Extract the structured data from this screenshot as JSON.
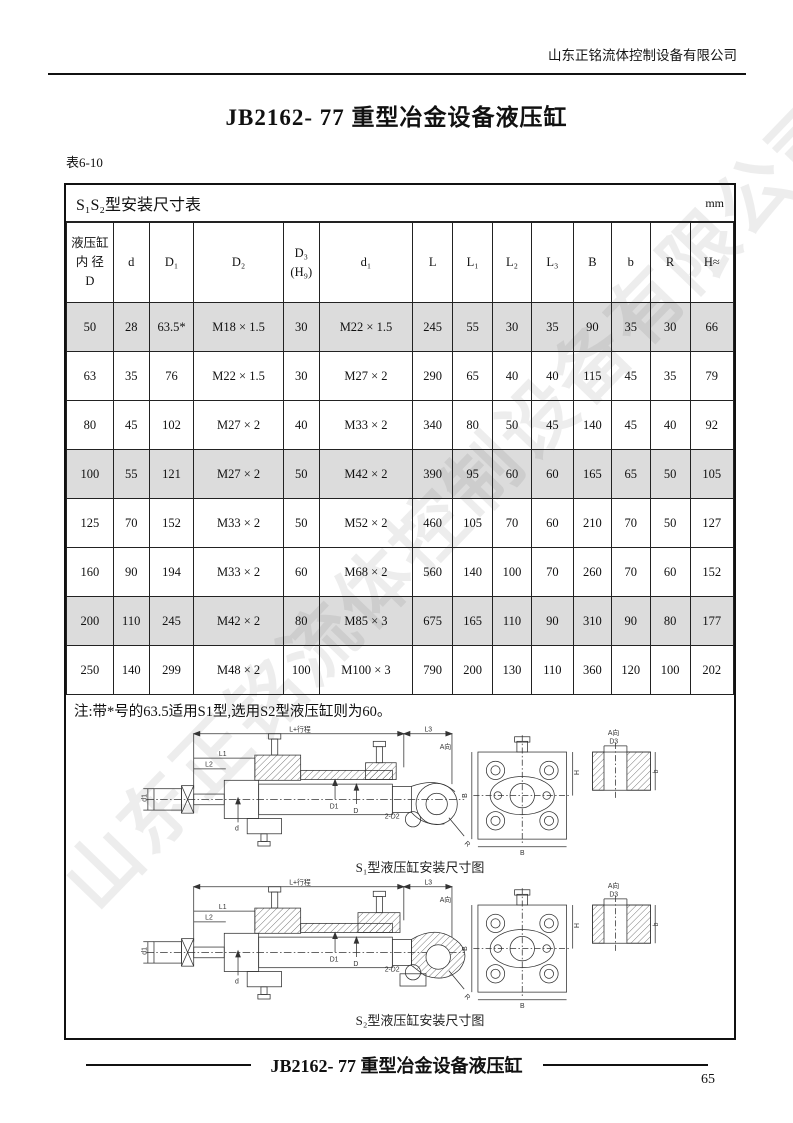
{
  "page": {
    "company": "山东正铭流体控制设备有限公司",
    "title": "JB2162- 77 重型冶金设备液压缸",
    "table_label": "表6-10",
    "footer_title": "JB2162- 77 重型冶金设备液压缸",
    "page_number": "65",
    "watermark": "山东正铭流体控制设备有限公司"
  },
  "table": {
    "title": "S₁S₂型安装尺寸表",
    "unit": "mm",
    "headers": [
      "液压缸\n内 径\nD",
      "d",
      "D₁",
      "D₂",
      "D₃\n(H₉)",
      "d₁",
      "L",
      "L₁",
      "L₂",
      "L₃",
      "B",
      "b",
      "R",
      "H≈"
    ],
    "rows": [
      [
        "50",
        "28",
        "63.5*",
        "M18 × 1.5",
        "30",
        "M22 × 1.5",
        "245",
        "55",
        "30",
        "35",
        "90",
        "35",
        "30",
        "66"
      ],
      [
        "63",
        "35",
        "76",
        "M22 × 1.5",
        "30",
        "M27 × 2",
        "290",
        "65",
        "40",
        "40",
        "115",
        "45",
        "35",
        "79"
      ],
      [
        "80",
        "45",
        "102",
        "M27 × 2",
        "40",
        "M33 × 2",
        "340",
        "80",
        "50",
        "45",
        "140",
        "45",
        "40",
        "92"
      ],
      [
        "100",
        "55",
        "121",
        "M27 × 2",
        "50",
        "M42 × 2",
        "390",
        "95",
        "60",
        "60",
        "165",
        "65",
        "50",
        "105"
      ],
      [
        "125",
        "70",
        "152",
        "M33 × 2",
        "50",
        "M52 × 2",
        "460",
        "105",
        "70",
        "60",
        "210",
        "70",
        "50",
        "127"
      ],
      [
        "160",
        "90",
        "194",
        "M33 × 2",
        "60",
        "M68 × 2",
        "560",
        "140",
        "100",
        "70",
        "260",
        "70",
        "60",
        "152"
      ],
      [
        "200",
        "110",
        "245",
        "M42 × 2",
        "80",
        "M85 × 3",
        "675",
        "165",
        "110",
        "90",
        "310",
        "90",
        "80",
        "177"
      ],
      [
        "250",
        "140",
        "299",
        "M48 × 2",
        "100",
        "M100 × 3",
        "790",
        "200",
        "130",
        "110",
        "360",
        "120",
        "100",
        "202"
      ]
    ],
    "note": "注:带*号的63.5适用S1型,选用S2型液压缸则为60。"
  },
  "diagrams": {
    "s1_caption": "S₁型液压缸安装尺寸图",
    "s2_caption": "S₂型液压缸安装尺寸图",
    "labels": {
      "stroke": "L+行程",
      "L1": "L1",
      "L2": "L2",
      "L3": "L3",
      "d1": "d1",
      "d": "d",
      "D1": "D1",
      "D": "D",
      "D2": "2-D2",
      "R": "R",
      "A_view": "A向",
      "D3": "D3",
      "b": "b",
      "B": "B",
      "H": "H"
    }
  }
}
